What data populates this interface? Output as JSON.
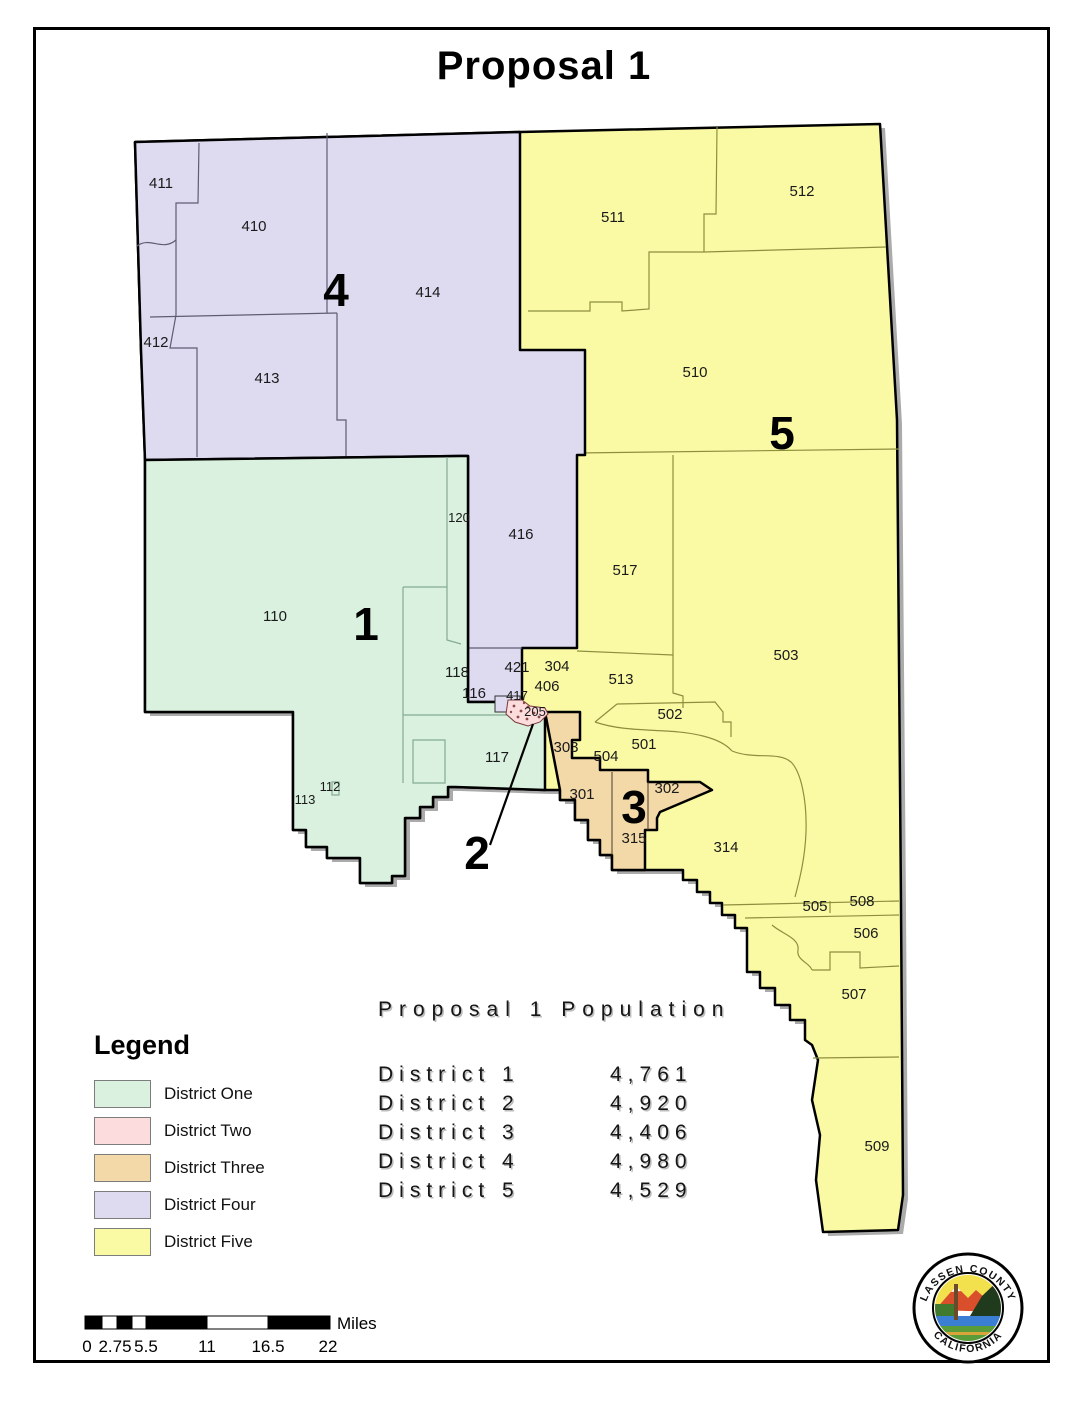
{
  "title": "Proposal 1",
  "map": {
    "district_numbers": [
      {
        "text": "1",
        "x": 366,
        "y": 624
      },
      {
        "text": "2",
        "x": 477,
        "y": 853
      },
      {
        "text": "3",
        "x": 634,
        "y": 807
      },
      {
        "text": "4",
        "x": 336,
        "y": 290
      },
      {
        "text": "5",
        "x": 782,
        "y": 433
      }
    ],
    "precinct_labels": [
      {
        "text": "411",
        "x": 161,
        "y": 188
      },
      {
        "text": "410",
        "x": 254,
        "y": 231
      },
      {
        "text": "412",
        "x": 156,
        "y": 347
      },
      {
        "text": "413",
        "x": 267,
        "y": 383
      },
      {
        "text": "414",
        "x": 428,
        "y": 297
      },
      {
        "text": "416",
        "x": 521,
        "y": 539
      },
      {
        "text": "120",
        "x": 459,
        "y": 522,
        "small": true
      },
      {
        "text": "421",
        "x": 517,
        "y": 672
      },
      {
        "text": "417",
        "x": 517,
        "y": 700,
        "small": true
      },
      {
        "text": "406",
        "x": 547,
        "y": 691
      },
      {
        "text": "304",
        "x": 557,
        "y": 671
      },
      {
        "text": "205",
        "x": 535,
        "y": 716,
        "small": true
      },
      {
        "text": "110",
        "x": 275,
        "y": 621
      },
      {
        "text": "118",
        "x": 457,
        "y": 677
      },
      {
        "text": "116",
        "x": 474,
        "y": 698
      },
      {
        "text": "117",
        "x": 497,
        "y": 762
      },
      {
        "text": "112",
        "x": 330,
        "y": 791,
        "small": true
      },
      {
        "text": "113",
        "x": 305,
        "y": 804,
        "small": true
      },
      {
        "text": "303",
        "x": 566,
        "y": 752
      },
      {
        "text": "301",
        "x": 582,
        "y": 799
      },
      {
        "text": "302",
        "x": 667,
        "y": 793
      },
      {
        "text": "315",
        "x": 634,
        "y": 843
      },
      {
        "text": "511",
        "x": 613,
        "y": 222
      },
      {
        "text": "512",
        "x": 802,
        "y": 196
      },
      {
        "text": "510",
        "x": 695,
        "y": 377
      },
      {
        "text": "517",
        "x": 625,
        "y": 575
      },
      {
        "text": "513",
        "x": 621,
        "y": 684
      },
      {
        "text": "503",
        "x": 786,
        "y": 660
      },
      {
        "text": "502",
        "x": 670,
        "y": 719
      },
      {
        "text": "501",
        "x": 644,
        "y": 749
      },
      {
        "text": "504",
        "x": 606,
        "y": 761
      },
      {
        "text": "314",
        "x": 726,
        "y": 852
      },
      {
        "text": "505",
        "x": 815,
        "y": 911
      },
      {
        "text": "508",
        "x": 862,
        "y": 906
      },
      {
        "text": "506",
        "x": 866,
        "y": 938
      },
      {
        "text": "507",
        "x": 854,
        "y": 999
      },
      {
        "text": "509",
        "x": 877,
        "y": 1151
      }
    ],
    "colors": {
      "district1": "#d9f1de",
      "district2": "#fcdcdd",
      "district3": "#f3d9a7",
      "district4": "#dedaf0",
      "district5": "#fafaa5",
      "boundary": "#000000",
      "shadow": "#ababab"
    }
  },
  "legend": {
    "heading": "Legend",
    "items": [
      {
        "label": "District One",
        "color": "#d9f1de"
      },
      {
        "label": "District Two",
        "color": "#fcdcdd"
      },
      {
        "label": "District Three",
        "color": "#f3d9a7"
      },
      {
        "label": "District Four",
        "color": "#dedaf0"
      },
      {
        "label": "District Five",
        "color": "#fafaa5"
      }
    ]
  },
  "population": {
    "title": "Proposal 1 Population",
    "rows": [
      {
        "label": "District 1",
        "value": "4,761"
      },
      {
        "label": "District 2",
        "value": "4,920"
      },
      {
        "label": "District 3",
        "value": "4,406"
      },
      {
        "label": "District 4",
        "value": "4,980"
      },
      {
        "label": "District 5",
        "value": "4,529"
      }
    ]
  },
  "scale_bar": {
    "ticks": [
      "0",
      "2.75",
      "5.5",
      "11",
      "16.5",
      "22"
    ],
    "unit": "Miles"
  },
  "seal": {
    "top_text": "LASSEN COUNTY",
    "bottom_text": "CALIFORNIA"
  }
}
